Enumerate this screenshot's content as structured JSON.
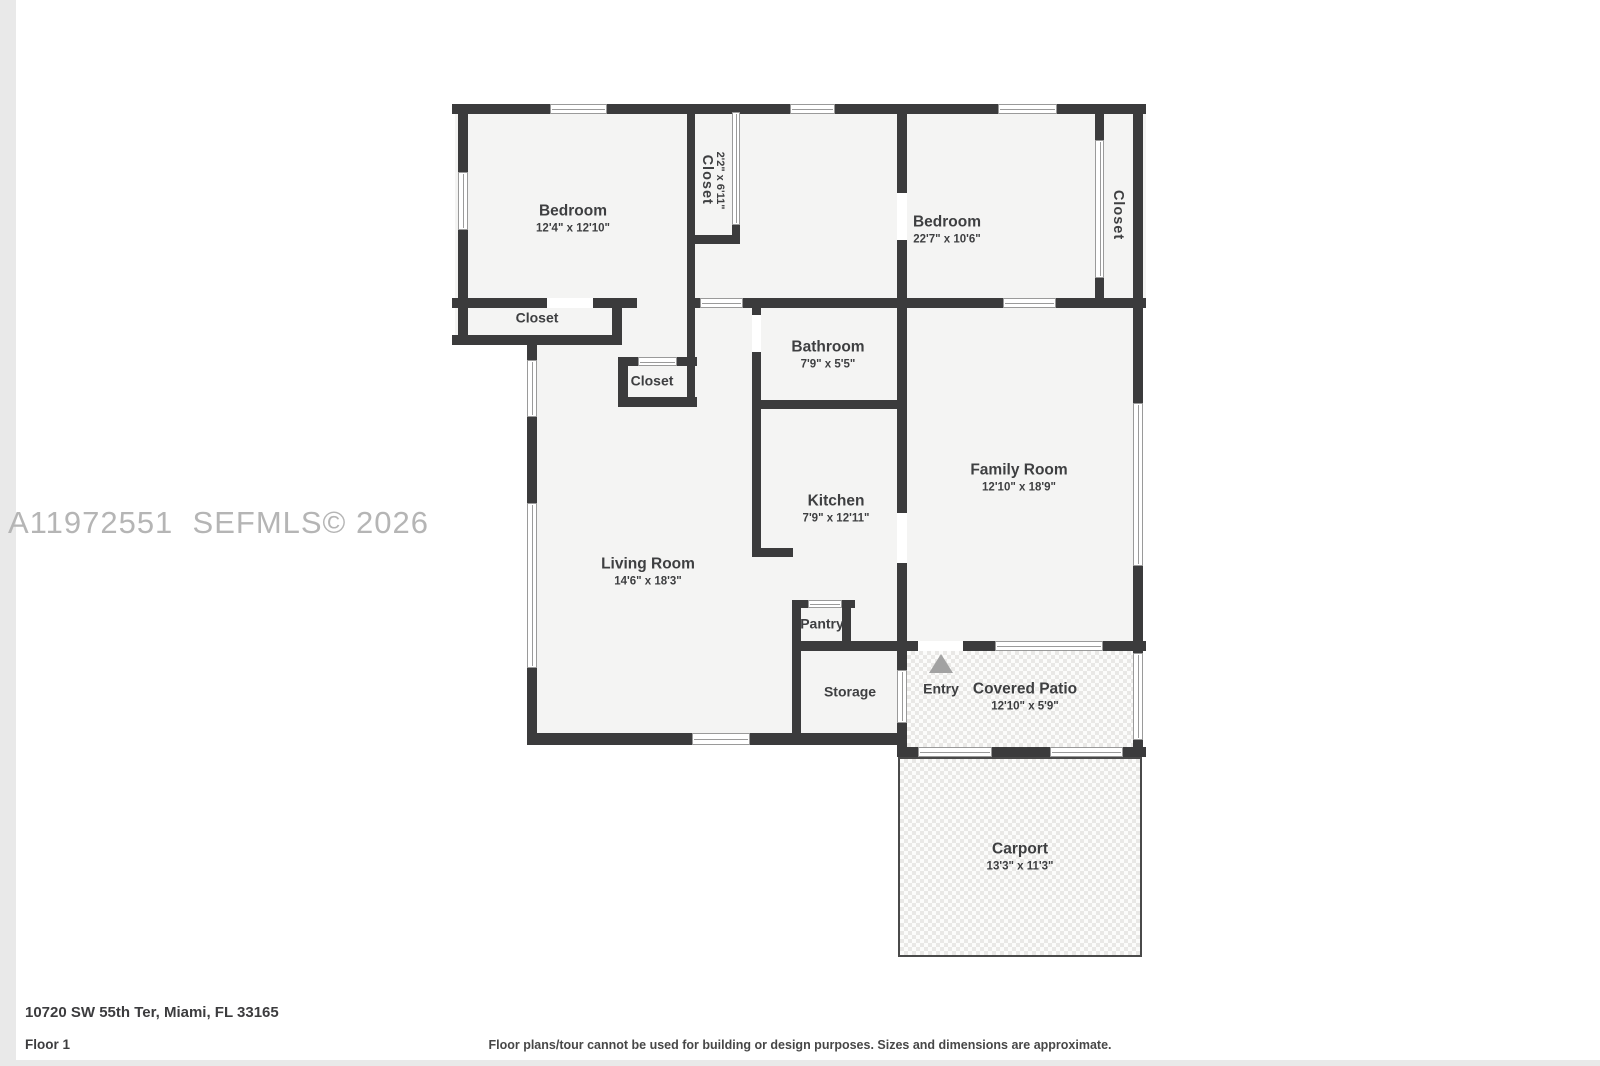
{
  "watermark": {
    "text": "A11972551  SEFMLS© 2026"
  },
  "footer": {
    "address": "10720 SW 55th Ter, Miami, FL 33165",
    "floor": "Floor 1",
    "disclaimer": "Floor plans/tour cannot be used for building or design purposes. Sizes and dimensions are approximate."
  },
  "colors": {
    "wall": "#3b3b3c",
    "room_fill": "#f4f4f3",
    "label": "#3e3f41",
    "watermark": "#b5b5b5",
    "tile_checker": "#e9e8e6",
    "page_frame": "#e9e9e9",
    "entry_arrow": "#a2a2a2",
    "window_line": "#9a9a9a"
  },
  "plan": {
    "fills": [
      [
        455,
        104,
        691,
        204
      ],
      [
        455,
        298,
        167,
        47
      ],
      [
        527,
        306,
        616,
        439
      ]
    ],
    "patio": {
      "rect": [
        907,
        651,
        236,
        96
      ]
    },
    "carport": {
      "rect": [
        898,
        757,
        244,
        200
      ]
    },
    "walls": [
      [
        452,
        104,
        98,
        10
      ],
      [
        607,
        104,
        183,
        10
      ],
      [
        835,
        104,
        163,
        10
      ],
      [
        1057,
        104,
        89,
        10
      ],
      [
        452,
        298,
        95,
        10
      ],
      [
        593,
        298,
        44,
        10
      ],
      [
        687,
        298,
        13,
        10
      ],
      [
        743,
        298,
        260,
        10
      ],
      [
        1056,
        298,
        90,
        10
      ],
      [
        687,
        235,
        53,
        9
      ],
      [
        452,
        335,
        170,
        10
      ],
      [
        618,
        357,
        20,
        9
      ],
      [
        677,
        357,
        20,
        9
      ],
      [
        618,
        397,
        79,
        10
      ],
      [
        752,
        400,
        155,
        9
      ],
      [
        753,
        548,
        40,
        9
      ],
      [
        792,
        600,
        16,
        8
      ],
      [
        842,
        600,
        13,
        8
      ],
      [
        792,
        641,
        126,
        10
      ],
      [
        963,
        641,
        32,
        10
      ],
      [
        1103,
        641,
        43,
        10
      ],
      [
        527,
        733,
        165,
        12
      ],
      [
        750,
        733,
        157,
        12
      ],
      [
        898,
        747,
        20,
        10
      ],
      [
        992,
        747,
        58,
        10
      ],
      [
        1123,
        747,
        23,
        10
      ],
      [
        458,
        104,
        10,
        68
      ],
      [
        458,
        230,
        10,
        115
      ],
      [
        527,
        335,
        10,
        25
      ],
      [
        527,
        417,
        10,
        86
      ],
      [
        527,
        668,
        10,
        77
      ],
      [
        687,
        104,
        8,
        303
      ],
      [
        732,
        225,
        8,
        19
      ],
      [
        612,
        298,
        10,
        47
      ],
      [
        618,
        357,
        10,
        50
      ],
      [
        752,
        306,
        9,
        9
      ],
      [
        752,
        352,
        9,
        205
      ],
      [
        897,
        104,
        10,
        89
      ],
      [
        897,
        240,
        10,
        273
      ],
      [
        897,
        563,
        10,
        107
      ],
      [
        897,
        723,
        10,
        34
      ],
      [
        1095,
        104,
        9,
        36
      ],
      [
        1095,
        278,
        9,
        27
      ],
      [
        1133,
        104,
        10,
        299
      ],
      [
        1133,
        566,
        10,
        87
      ],
      [
        1133,
        740,
        10,
        17
      ],
      [
        792,
        600,
        9,
        145
      ],
      [
        842,
        600,
        9,
        50
      ]
    ],
    "gaps": [
      [
        547,
        298,
        46,
        10
      ],
      [
        752,
        315,
        9,
        37
      ],
      [
        897,
        193,
        10,
        47
      ],
      [
        897,
        513,
        10,
        50
      ],
      [
        918,
        641,
        45,
        10
      ]
    ],
    "windows": [
      [
        550,
        104,
        57,
        10
      ],
      [
        790,
        104,
        45,
        10
      ],
      [
        998,
        104,
        59,
        10
      ],
      [
        458,
        172,
        10,
        58
      ],
      [
        527,
        360,
        10,
        57
      ],
      [
        527,
        503,
        10,
        165
      ],
      [
        1133,
        403,
        10,
        163
      ],
      [
        1133,
        653,
        10,
        87
      ],
      [
        700,
        298,
        43,
        10
      ],
      [
        1003,
        298,
        53,
        10
      ],
      [
        638,
        357,
        39,
        9
      ],
      [
        732,
        112,
        8,
        113
      ],
      [
        1095,
        140,
        9,
        138
      ],
      [
        808,
        600,
        34,
        8
      ],
      [
        995,
        641,
        108,
        10
      ],
      [
        918,
        747,
        74,
        10
      ],
      [
        1050,
        747,
        73,
        10
      ],
      [
        692,
        733,
        58,
        12
      ],
      [
        897,
        670,
        10,
        53
      ]
    ],
    "rooms": [
      {
        "id": "bedroom-1",
        "name": "Bedroom",
        "dims": "12'4\" x 12'10\"",
        "x": 573,
        "y": 219,
        "small": false
      },
      {
        "id": "bedroom-2",
        "name": "Bedroom",
        "dims": "22'7\" x 10'6\"",
        "x": 947,
        "y": 230,
        "small": false
      },
      {
        "id": "closet-left",
        "name": "Closet",
        "dims": "",
        "x": 537,
        "y": 318,
        "small": true
      },
      {
        "id": "closet-small",
        "name": "Closet",
        "dims": "",
        "x": 652,
        "y": 381,
        "small": true
      },
      {
        "id": "bathroom",
        "name": "Bathroom",
        "dims": "7'9\" x 5'5\"",
        "x": 828,
        "y": 355,
        "small": false
      },
      {
        "id": "family-room",
        "name": "Family Room",
        "dims": "12'10\" x 18'9\"",
        "x": 1019,
        "y": 478,
        "small": false
      },
      {
        "id": "kitchen",
        "name": "Kitchen",
        "dims": "7'9\" x 12'11\"",
        "x": 836,
        "y": 509,
        "small": false
      },
      {
        "id": "living-room",
        "name": "Living Room",
        "dims": "14'6\" x 18'3\"",
        "x": 648,
        "y": 572,
        "small": false
      },
      {
        "id": "pantry",
        "name": "Pantry",
        "dims": "",
        "x": 822,
        "y": 624,
        "small": true
      },
      {
        "id": "storage",
        "name": "Storage",
        "dims": "",
        "x": 850,
        "y": 692,
        "small": true
      },
      {
        "id": "entry",
        "name": "Entry",
        "dims": "",
        "x": 941,
        "y": 689,
        "small": true
      },
      {
        "id": "covered-patio",
        "name": "Covered Patio",
        "dims": "12'10\" x 5'9\"",
        "x": 1025,
        "y": 697,
        "small": false
      },
      {
        "id": "carport",
        "name": "Carport",
        "dims": "13'3\" x 11'3\"",
        "x": 1020,
        "y": 857,
        "small": false
      }
    ],
    "vertical_rooms": [
      {
        "id": "closet-hall",
        "name": "Closet",
        "dims": "2'2\" x 6'11\"",
        "x": 712,
        "y": 180
      },
      {
        "id": "closet-right",
        "name": "Closet",
        "dims": "",
        "x": 1117,
        "y": 215
      }
    ],
    "entry_arrow": {
      "x": 929,
      "y": 654
    }
  }
}
